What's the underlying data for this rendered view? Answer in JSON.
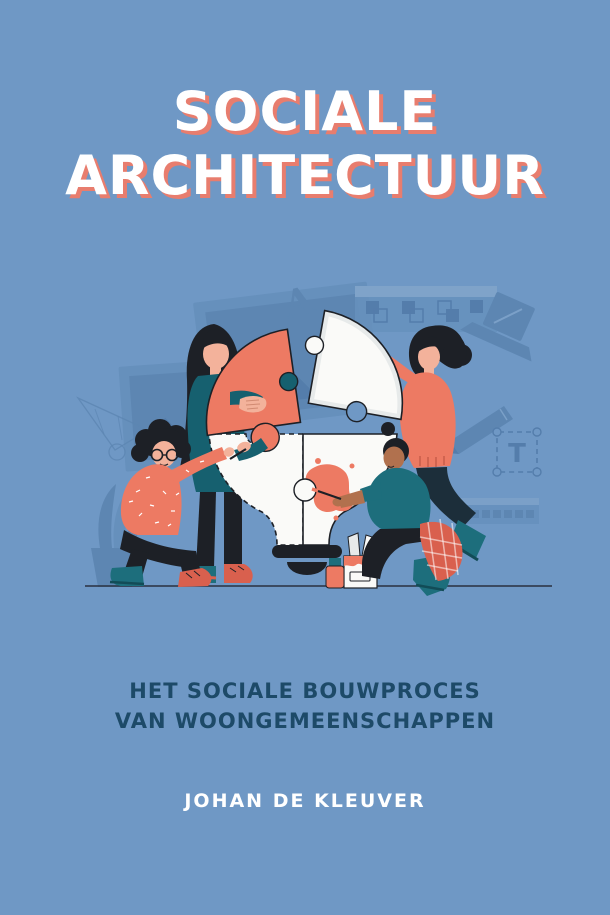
{
  "cover": {
    "title": {
      "line1": "SOCIALE",
      "line2": "ARCHITECTUUR"
    },
    "subtitle": {
      "line1": "HET SOCIALE BOUWPROCES",
      "line2": "VAN WOONGEMEENSCHAPPEN"
    },
    "author": "JOHAN DE KLEUVER"
  },
  "illustration": {
    "letter_glyph": "A",
    "text_tool_glyph": "T"
  },
  "colors": {
    "bg": "#6f98c5",
    "title-fill": "#ffffff",
    "title-shadow": "#e87d6e",
    "subtitle-text": "#1d4a68",
    "author-text": "#ffffff",
    "coral": "#ed7a63",
    "coral-dark": "#d9604e",
    "teal": "#16606f",
    "teal-mid": "#1d6e7c",
    "teal-deep": "#124c57",
    "ink": "#1d2026",
    "piece-white": "#fafaf8",
    "piece-gray": "#e7eaea",
    "skin-light": "#f3b29b",
    "skin-dark": "#b1714e",
    "decor-blue": "#5d86b2",
    "decor-blue-mid": "#6690bc",
    "decor-blue-deep": "#547dab",
    "pants-navy": "#1c2e3a",
    "ground": "#2a3140"
  }
}
